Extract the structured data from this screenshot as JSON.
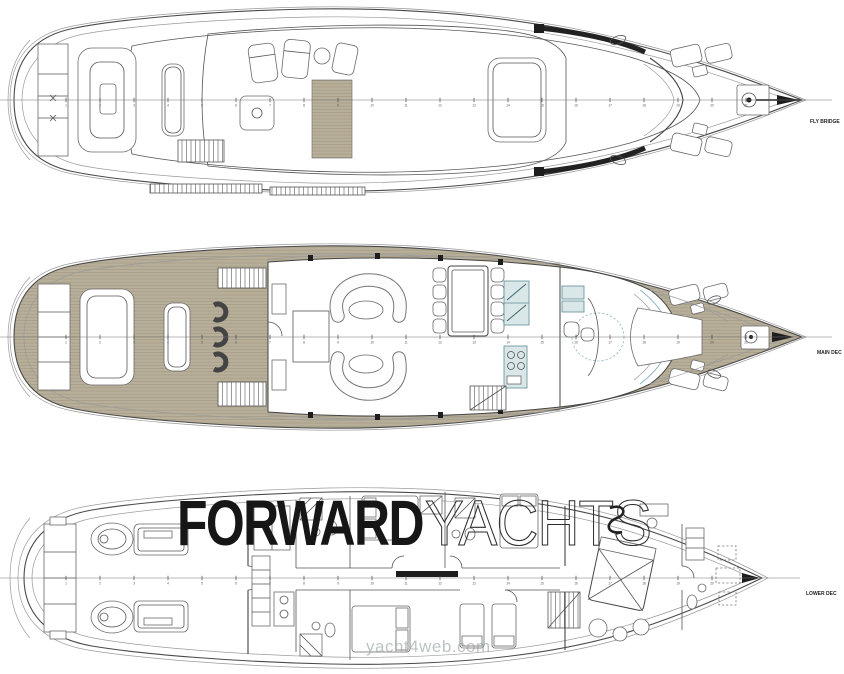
{
  "page": {
    "background": "#ffffff"
  },
  "decks": [
    {
      "id": "fly-bridge",
      "label": "FLY BRIDGE"
    },
    {
      "id": "main-deck",
      "label": "MAIN DEC"
    },
    {
      "id": "lower-deck",
      "label": "LOWER DEC"
    }
  ],
  "watermarks": {
    "brand_bold": "FORWARD",
    "brand_outline": "YACHTS",
    "site": "yacht4web.com"
  },
  "stations": [
    {
      "name": "station-scale-fly",
      "y": 100,
      "x_start": 66,
      "spacing": 34,
      "count": 21
    },
    {
      "name": "station-scale-main",
      "y": 337,
      "x_start": 66,
      "spacing": 34,
      "count": 21
    },
    {
      "name": "station-scale-lower",
      "y": 578,
      "x_start": 66,
      "spacing": 34,
      "count": 20
    }
  ],
  "colors": {
    "teak": "#b8af9a",
    "plank": "#a0977f",
    "line": "#4a4a4a",
    "galley": "#d9e7e8",
    "galley_stroke": "#5e8d94",
    "glass": "#8fb5c4",
    "brand": "#161616",
    "outline": "#2b2b2b",
    "site": "#96a1a1"
  }
}
